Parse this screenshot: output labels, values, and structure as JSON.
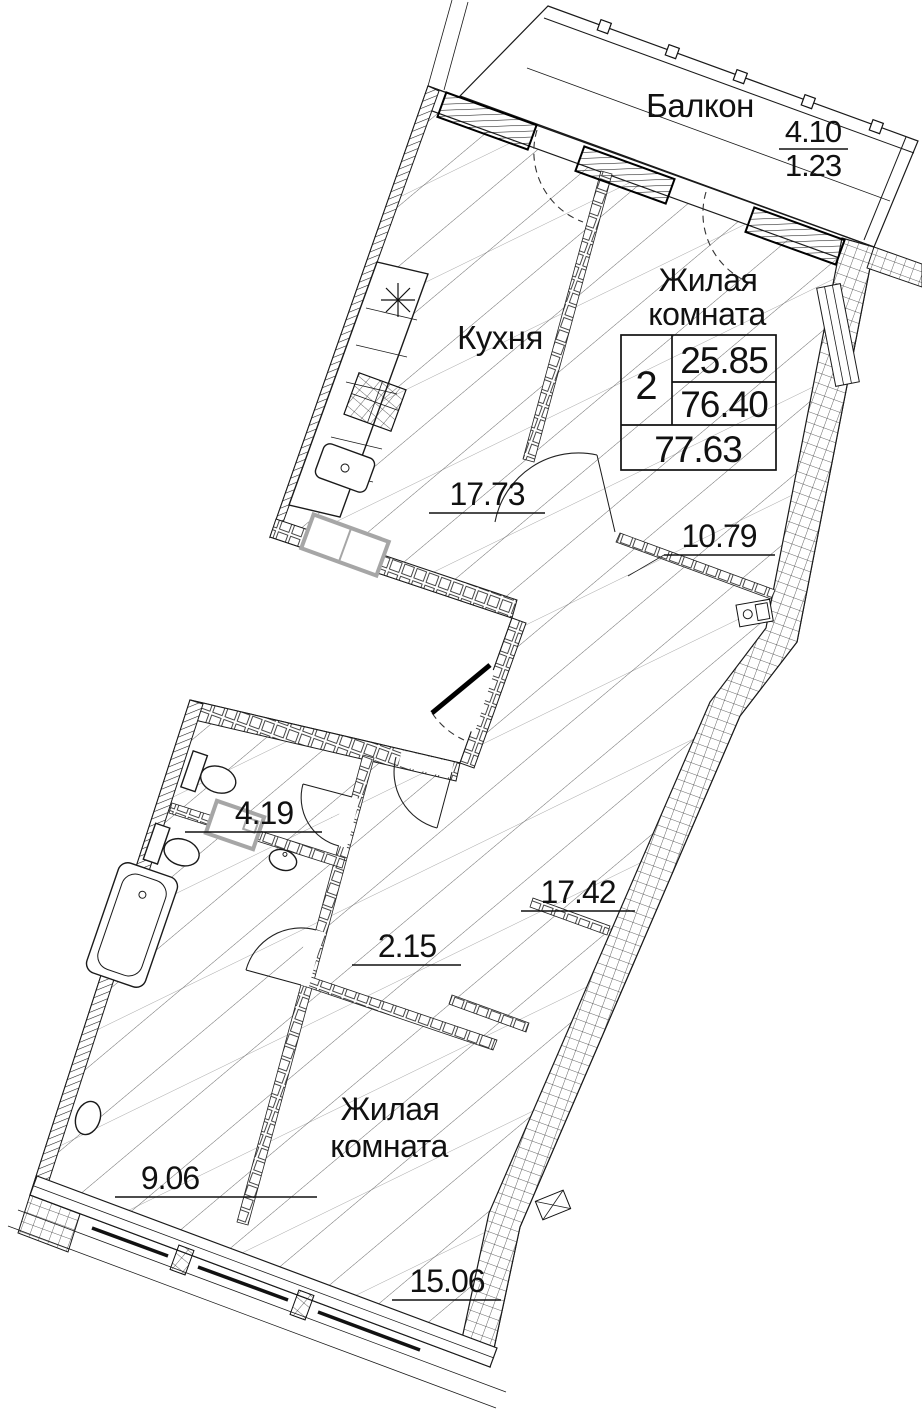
{
  "drawing": {
    "type": "apartment-floor-plan",
    "colors": {
      "ink": "#1a1a1a",
      "paper": "#ffffff",
      "appliance_gray": "#a6a6a6"
    }
  },
  "stamp": {
    "rooms_count": "2",
    "living_area": "25.85",
    "total_area": "76.40",
    "total_area_with_balcony": "77.63"
  },
  "rooms": {
    "balcony": {
      "name": "Балкон",
      "area": "4.10",
      "reduced_area": "1.23"
    },
    "kitchen": {
      "name": "Кухня",
      "area": "17.73"
    },
    "living_room_1": {
      "name_line1": "Жилая",
      "name_line2": "комната",
      "area": "10.79"
    },
    "hallway": {
      "area": "17.42"
    },
    "bathroom_1": {
      "area": "4.19"
    },
    "closet": {
      "area": "2.15"
    },
    "bathroom_2": {
      "area": "9.06"
    },
    "living_room_2": {
      "name_line1": "Жилая",
      "name_line2": "комната",
      "area": "15.06"
    }
  }
}
